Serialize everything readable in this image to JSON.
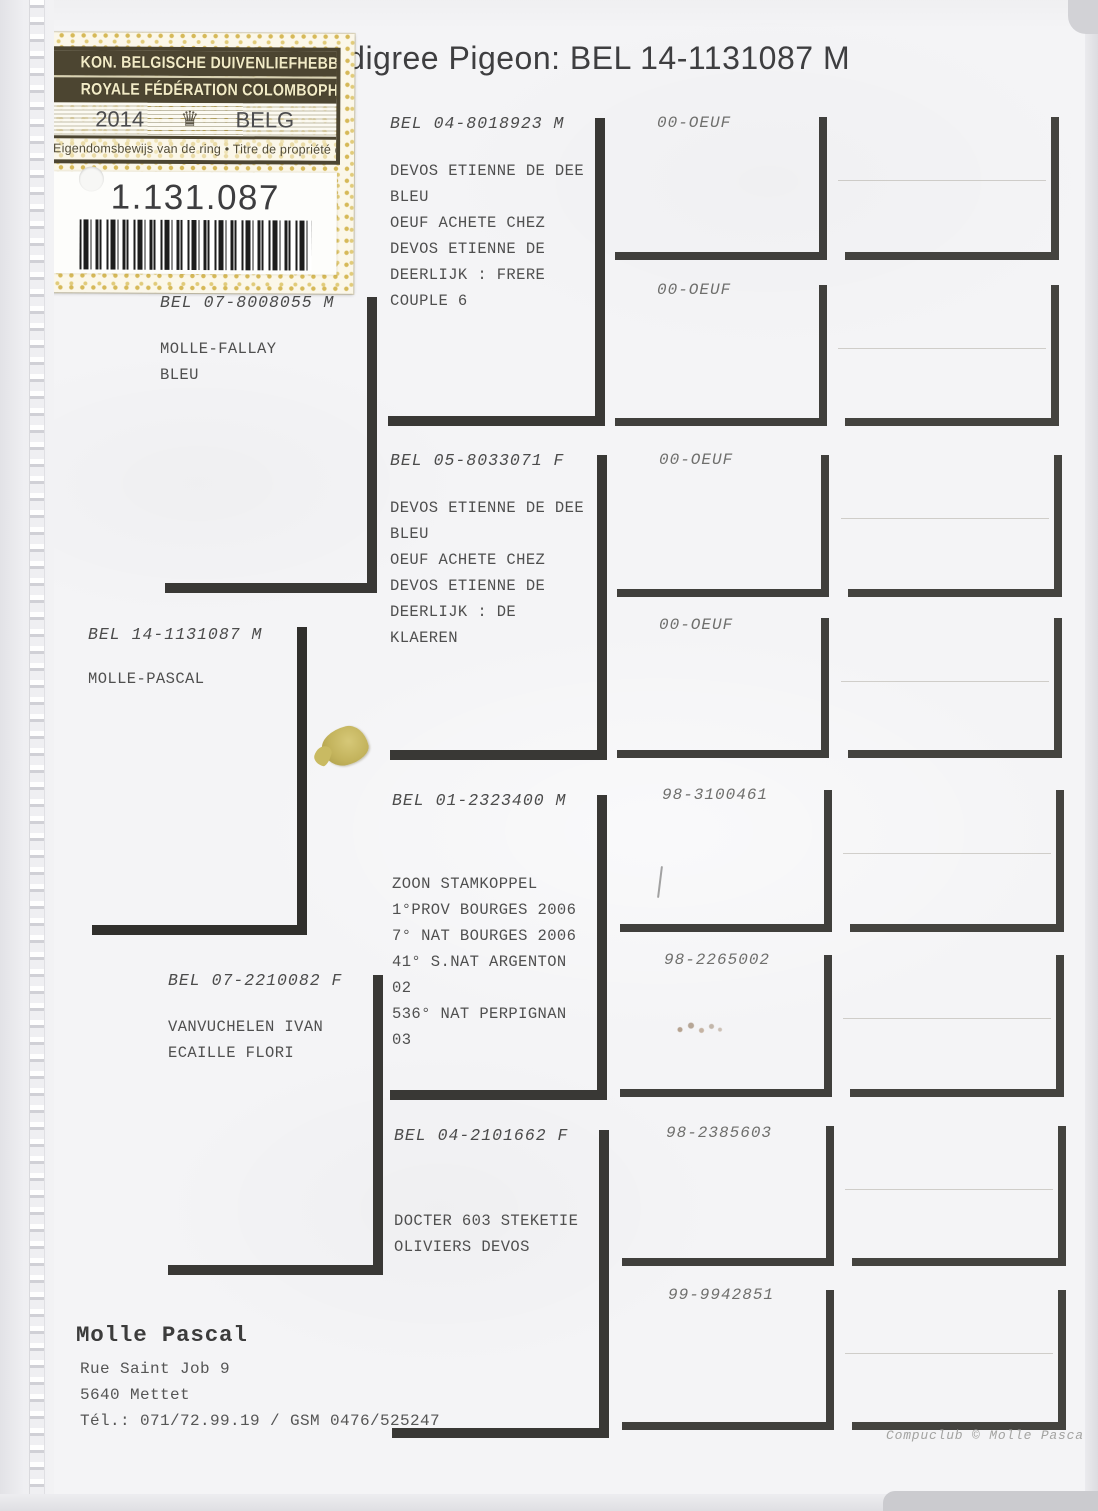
{
  "title": "Pedigree Pigeon: BEL 14-1131087 M",
  "sticker": {
    "federation_nl": "KON. BELGISCHE DUIVENLIEFHEBBERSBOND",
    "federation_fr": "ROYALE FÉDÉRATION COLOMBOPHILE BELGE",
    "year": "2014",
    "crown_icon": "♛",
    "country": "BELG",
    "ownership_text": "Eigendomsbewijs van de ring • Titre de propriété de la bague",
    "ring_number": "1.131.087"
  },
  "pedigree": {
    "subject": {
      "ring": "BEL 14-1131087 M",
      "lines": [
        "MOLLE-PASCAL"
      ]
    },
    "parents": [
      {
        "ring": "BEL 07-8008055 M",
        "lines": [
          "MOLLE-FALLAY",
          "BLEU"
        ]
      },
      {
        "ring": "BEL 07-2210082 F",
        "lines": [
          "VANVUCHELEN IVAN",
          "ECAILLE FLORI"
        ]
      }
    ],
    "grandparents": [
      {
        "ring": "BEL 04-8018923 M",
        "lines": [
          "DEVOS ETIENNE DE DEE",
          "BLEU",
          "OEUF ACHETE CHEZ",
          "DEVOS ETIENNE DE",
          "DEERLIJK : FRERE",
          "COUPLE 6"
        ]
      },
      {
        "ring": "BEL 05-8033071 F",
        "lines": [
          "DEVOS ETIENNE DE DEE",
          "BLEU",
          "OEUF ACHETE CHEZ",
          "DEVOS ETIENNE DE",
          "DEERLIJK : DE",
          "KLAEREN"
        ]
      },
      {
        "ring": "BEL 01-2323400 M",
        "lines": [
          "ZOON STAMKOPPEL",
          "1°PROV BOURGES 2006",
          "7° NAT BOURGES 2006",
          "41° S.NAT ARGENTON",
          "02",
          "536° NAT PERPIGNAN",
          "03"
        ]
      },
      {
        "ring": "BEL 04-2101662 F",
        "lines": [
          "DOCTER 603 STEKETIE",
          "OLIVIERS DEVOS"
        ]
      }
    ],
    "great_grandparents": [
      "00-OEUF",
      "00-OEUF",
      "00-OEUF",
      "00-OEUF",
      "98-3100461",
      "98-2265002",
      "98-2385603",
      "99-9942851"
    ]
  },
  "footer": {
    "owner": "Molle Pascal",
    "address_lines": [
      "Rue Saint Job 9",
      "5640  Mettet",
      "Tél.: 071/72.99.19 / GSM 0476/525247"
    ],
    "credit": "Compuclub © Molle Pascal"
  },
  "colors": {
    "sticker_gold": "#d2b248",
    "sticker_band": "#4c4531",
    "bracket_line": "#393835",
    "paper": "#f4f4f6"
  }
}
